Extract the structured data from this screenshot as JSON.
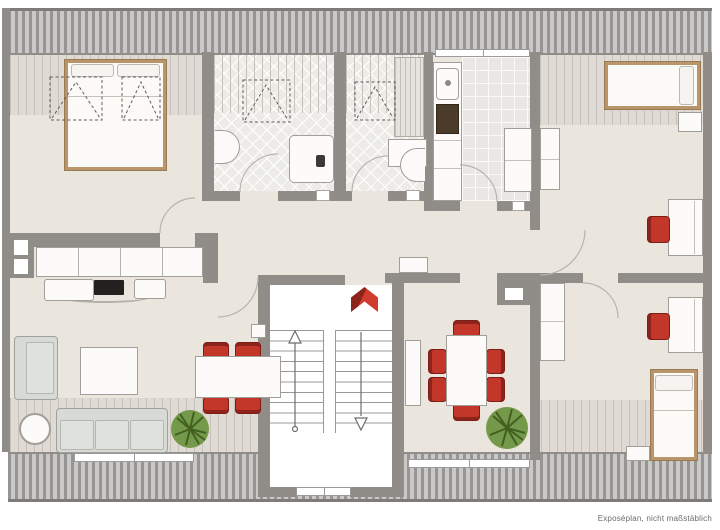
{
  "plan": {
    "caption": "Exposéplan, nicht maßstäblich",
    "colors": {
      "wall": "#908d89",
      "floor": "#eae6de",
      "hatch_dark": "#979593",
      "hatch_light": "#cbc9c7",
      "stripe_line": "#c6c2bb",
      "tile": "#edebe7",
      "kitchen_tile": "#e8e7e5",
      "bed_frame": "#b8956b",
      "furniture_white": "#fcfbf9",
      "furniture_outline": "#a29e98",
      "accent_red": "#c23729",
      "accent_red_dark": "#8c241c",
      "plant_green": "#74994a",
      "plant_green_dark": "#42601f"
    }
  }
}
